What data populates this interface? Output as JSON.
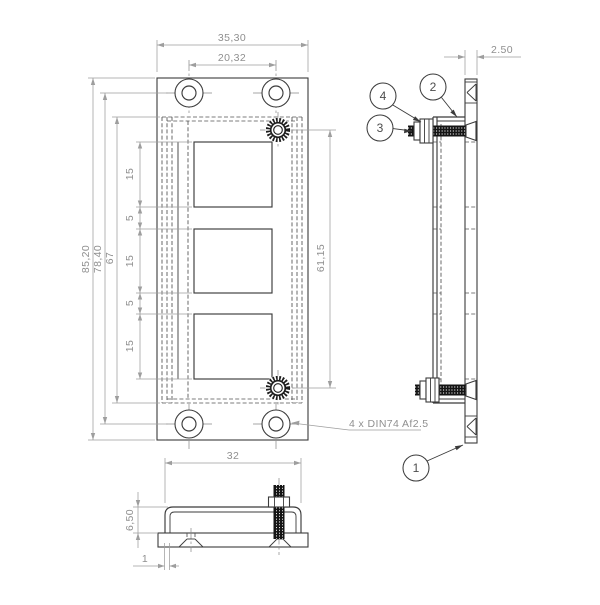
{
  "drawing": {
    "front": {
      "dim_overall_width": "35,30",
      "dim_hole_spacing_h": "20,32",
      "dim_overall_height": "85,20",
      "dim_hole_spacing_v": "78,40",
      "dim_bracket_length": "67",
      "segments": [
        "15",
        "5",
        "15",
        "5",
        "15"
      ],
      "dim_stud_spacing": "61,15",
      "hole_note": "4 x DIN74 Af2.5"
    },
    "side": {
      "dim_thickness": "2.50"
    },
    "bottom": {
      "dim_width": "32",
      "dim_height": "6,50",
      "dim_wall_thickness": "1"
    },
    "balloons": {
      "b1": "1",
      "b2": "2",
      "b3": "3",
      "b4": "4"
    }
  },
  "colors": {
    "line": "#3b3b3b",
    "dimension": "#8f8f8f",
    "background": "#ffffff"
  }
}
